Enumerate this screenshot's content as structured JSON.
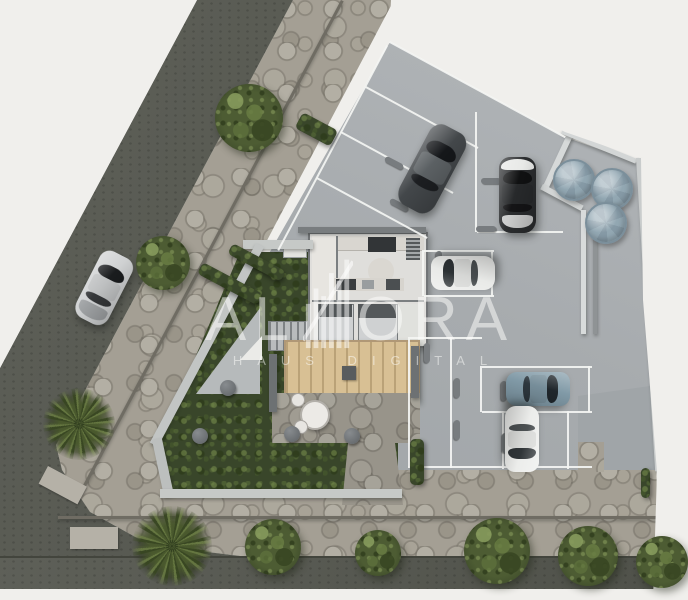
{
  "watermark": {
    "brand": "ALORA",
    "brand_left": "AL",
    "brand_right": "ORA",
    "tagline": "HAUS DIGITAL",
    "logo_icon": "building-skyline-icon"
  },
  "palette": {
    "bg": "#f0efec",
    "road": "#55574f",
    "stone": "#a49f94",
    "parking_light": "#b3b7ba",
    "parking_dark": "#9da2a5",
    "garden": "#39462a",
    "deck": "#d8c094",
    "tank": "#92a7b2",
    "line": "#f4f5f3"
  },
  "scene": {
    "cars": [
      {
        "name": "car-street-silver",
        "x": 86,
        "y": 251,
        "w": 36,
        "h": 74,
        "rot": 27,
        "body": "#cfd1d2",
        "glass": "#1a1c1e",
        "trunk": "#9fa2a4"
      },
      {
        "name": "car-suv-dark",
        "x": 412,
        "y": 124,
        "w": 40,
        "h": 90,
        "rot": 28,
        "body": "#43474a",
        "glass": "#15171a",
        "roof": "#5b6063"
      },
      {
        "name": "car-sedan-dark-white-hood",
        "x": 499,
        "y": 157,
        "w": 37,
        "h": 76,
        "rot": 0,
        "body": "#2b2d2f",
        "glass": "#101112",
        "hood": "#e8e9e7",
        "trunk": "#cbcccc"
      },
      {
        "name": "car-sedan-white-facing-left",
        "x": 446,
        "y": 241,
        "w": 34,
        "h": 64,
        "rot": -90,
        "body": "#e9eae8",
        "glass": "#2c3134"
      },
      {
        "name": "car-sedan-blue-gray",
        "x": 521,
        "y": 357,
        "w": 34,
        "h": 64,
        "rot": 90,
        "body": "#8099a6",
        "glass": "#1f262b"
      },
      {
        "name": "car-sedan-white-facing-down",
        "x": 505,
        "y": 406,
        "w": 34,
        "h": 66,
        "rot": 180,
        "body": "#ecedeb",
        "glass": "#303538"
      }
    ],
    "trees": [
      {
        "cx": 249,
        "cy": 118,
        "r": 34
      },
      {
        "cx": 163,
        "cy": 263,
        "r": 27
      },
      {
        "cx": 273,
        "cy": 547,
        "r": 28
      },
      {
        "cx": 378,
        "cy": 553,
        "r": 23
      },
      {
        "cx": 497,
        "cy": 551,
        "r": 33
      },
      {
        "cx": 588,
        "cy": 556,
        "r": 30
      },
      {
        "cx": 662,
        "cy": 562,
        "r": 26
      }
    ],
    "palms": [
      {
        "cx": 79,
        "cy": 424,
        "r": 36,
        "rot": 10
      },
      {
        "cx": 172,
        "cy": 546,
        "r": 40,
        "rot": -15
      }
    ],
    "tanks": [
      {
        "cx": 572,
        "cy": 178,
        "r": 19
      },
      {
        "c x": 0,
        "cx": 610,
        "cy": 187,
        "r": 19
      },
      {
        "cx": 604,
        "cy": 221,
        "r": 19
      }
    ],
    "parking_lines": [
      {
        "x": 390,
        "y": 41,
        "len": 200,
        "rot": 28.5
      },
      {
        "x": 388,
        "y": 46,
        "len": 232,
        "rot": 118
      },
      {
        "x": 366,
        "y": 86,
        "len": 128,
        "rot": 28.5
      },
      {
        "x": 341,
        "y": 131,
        "len": 128,
        "rot": 28.5
      },
      {
        "x": 317,
        "y": 177,
        "len": 126,
        "rot": 28.5
      },
      {
        "x": 477,
        "y": 112,
        "len": 120,
        "rot": 90
      },
      {
        "x": 477,
        "y": 231,
        "len": 86,
        "rot": 0
      },
      {
        "x": 424,
        "y": 250,
        "len": 70,
        "rot": 0
      },
      {
        "x": 424,
        "y": 295,
        "len": 70,
        "rot": 0
      },
      {
        "x": 493,
        "y": 250,
        "len": 46,
        "rot": 90
      },
      {
        "x": 424,
        "y": 250,
        "len": 46,
        "rot": 90
      },
      {
        "x": 410,
        "y": 337,
        "len": 131,
        "rot": 90
      },
      {
        "x": 452,
        "y": 337,
        "len": 131,
        "rot": 90
      },
      {
        "x": 410,
        "y": 337,
        "len": 72,
        "rot": 0
      },
      {
        "x": 482,
        "y": 366,
        "len": 110,
        "rot": 0
      },
      {
        "x": 482,
        "y": 411,
        "len": 110,
        "rot": 0
      },
      {
        "x": 482,
        "y": 366,
        "len": 46,
        "rot": 90
      },
      {
        "x": 590,
        "y": 366,
        "len": 46,
        "rot": 90
      },
      {
        "x": 504,
        "y": 411,
        "len": 58,
        "rot": 90
      },
      {
        "x": 569,
        "y": 411,
        "len": 58,
        "rot": 90
      },
      {
        "x": 408,
        "y": 466,
        "len": 184,
        "rot": 0
      }
    ],
    "wheel_stops": [
      {
        "x": 384,
        "y": 160,
        "r": 28
      },
      {
        "x": 389,
        "y": 202,
        "r": 28
      },
      {
        "x": 428,
        "y": 136,
        "r": 28
      },
      {
        "x": 481,
        "y": 178,
        "r": 0
      },
      {
        "x": 476,
        "y": 226,
        "r": 0
      },
      {
        "x": 429,
        "y": 258,
        "r": 90
      },
      {
        "x": 417,
        "y": 350,
        "r": 90
      },
      {
        "x": 447,
        "y": 385,
        "r": 90
      },
      {
        "x": 494,
        "y": 388,
        "r": 90
      },
      {
        "x": 447,
        "y": 427,
        "r": 90
      },
      {
        "x": 495,
        "y": 440,
        "r": 90
      }
    ],
    "stepping_stones": [
      {
        "cx": 228,
        "cy": 388
      },
      {
        "cx": 200,
        "cy": 436
      },
      {
        "cx": 292,
        "cy": 434
      },
      {
        "cx": 352,
        "cy": 436
      }
    ],
    "hedges": [
      {
        "x": 303,
        "y": 112,
        "w": 40,
        "h": 18,
        "rot": 28
      },
      {
        "x": 233,
        "y": 243,
        "w": 60,
        "h": 12,
        "rot": 28
      },
      {
        "x": 203,
        "y": 262,
        "w": 68,
        "h": 13,
        "rot": 28
      },
      {
        "x": 410,
        "y": 439,
        "w": 14,
        "h": 46,
        "rot": 0
      },
      {
        "x": 641,
        "y": 468,
        "w": 9,
        "h": 30,
        "rot": 0
      }
    ],
    "walls": [
      {
        "name": "garden-wall-top",
        "x": 243,
        "y": 240,
        "w": 70,
        "h": 9,
        "rot": 0,
        "c": "#c6c9c7"
      },
      {
        "name": "garden-wall-left",
        "x": 256,
        "y": 243,
        "w": 9,
        "h": 226,
        "rot": 28,
        "c": "#c2c5c4"
      },
      {
        "name": "garden-wall-corner",
        "x": 152,
        "y": 440,
        "w": 10,
        "h": 58,
        "rot": -12,
        "c": "#bcbfbe"
      },
      {
        "name": "garden-wall-bottom",
        "x": 160,
        "y": 489,
        "w": 242,
        "h": 9,
        "rot": 0,
        "c": "#c6c9c7"
      },
      {
        "name": "house-north-wall",
        "x": 298,
        "y": 227,
        "w": 128,
        "h": 6,
        "rot": 0,
        "c": "#797d7f"
      },
      {
        "name": "tank-wall-diagonal",
        "x": 543,
        "y": 186,
        "w": 58,
        "h": 6,
        "rot": -65,
        "c": "#d6d9d9"
      },
      {
        "name": "tank-wall-connector",
        "x": 543,
        "y": 184,
        "w": 46,
        "h": 6,
        "rot": 28,
        "c": "#d2d5d5"
      },
      {
        "name": "boundary-wall-top-right",
        "x": 563,
        "y": 129,
        "w": 80,
        "h": 5,
        "rot": 22,
        "c": "#d3d6d6"
      },
      {
        "name": "boundary-wall-right",
        "x": 636,
        "y": 158,
        "w": 5,
        "h": 314,
        "rot": -3.5,
        "c": "#c9cccc"
      },
      {
        "name": "channel-wall-a",
        "x": 581,
        "y": 210,
        "w": 5,
        "h": 124,
        "rot": 0,
        "c": "#d8dbdb"
      },
      {
        "name": "channel-wall-b",
        "x": 593,
        "y": 210,
        "w": 4,
        "h": 124,
        "rot": 0,
        "c": "#8f9395"
      },
      {
        "name": "curb-line-diagonal",
        "x": 341,
        "y": 0,
        "w": 3,
        "h": 558,
        "rot": 28,
        "c": "#6f6c63"
      },
      {
        "name": "curb-line-bottom",
        "x": 58,
        "y": 516,
        "w": 600,
        "h": 3,
        "rot": 0,
        "c": "#6f6c63"
      },
      {
        "name": "deck-edge-left",
        "x": 269,
        "y": 354,
        "w": 8,
        "h": 58,
        "rot": 0,
        "c": "#6d7173"
      },
      {
        "name": "deck-edge-right",
        "x": 411,
        "y": 346,
        "w": 8,
        "h": 52,
        "rot": 0,
        "c": "#6d7173"
      }
    ],
    "utility_pads": [
      {
        "x": 48,
        "y": 466,
        "w": 44,
        "h": 20,
        "rot": 28
      },
      {
        "x": 70,
        "y": 527,
        "w": 48,
        "h": 22,
        "rot": 0
      }
    ]
  }
}
